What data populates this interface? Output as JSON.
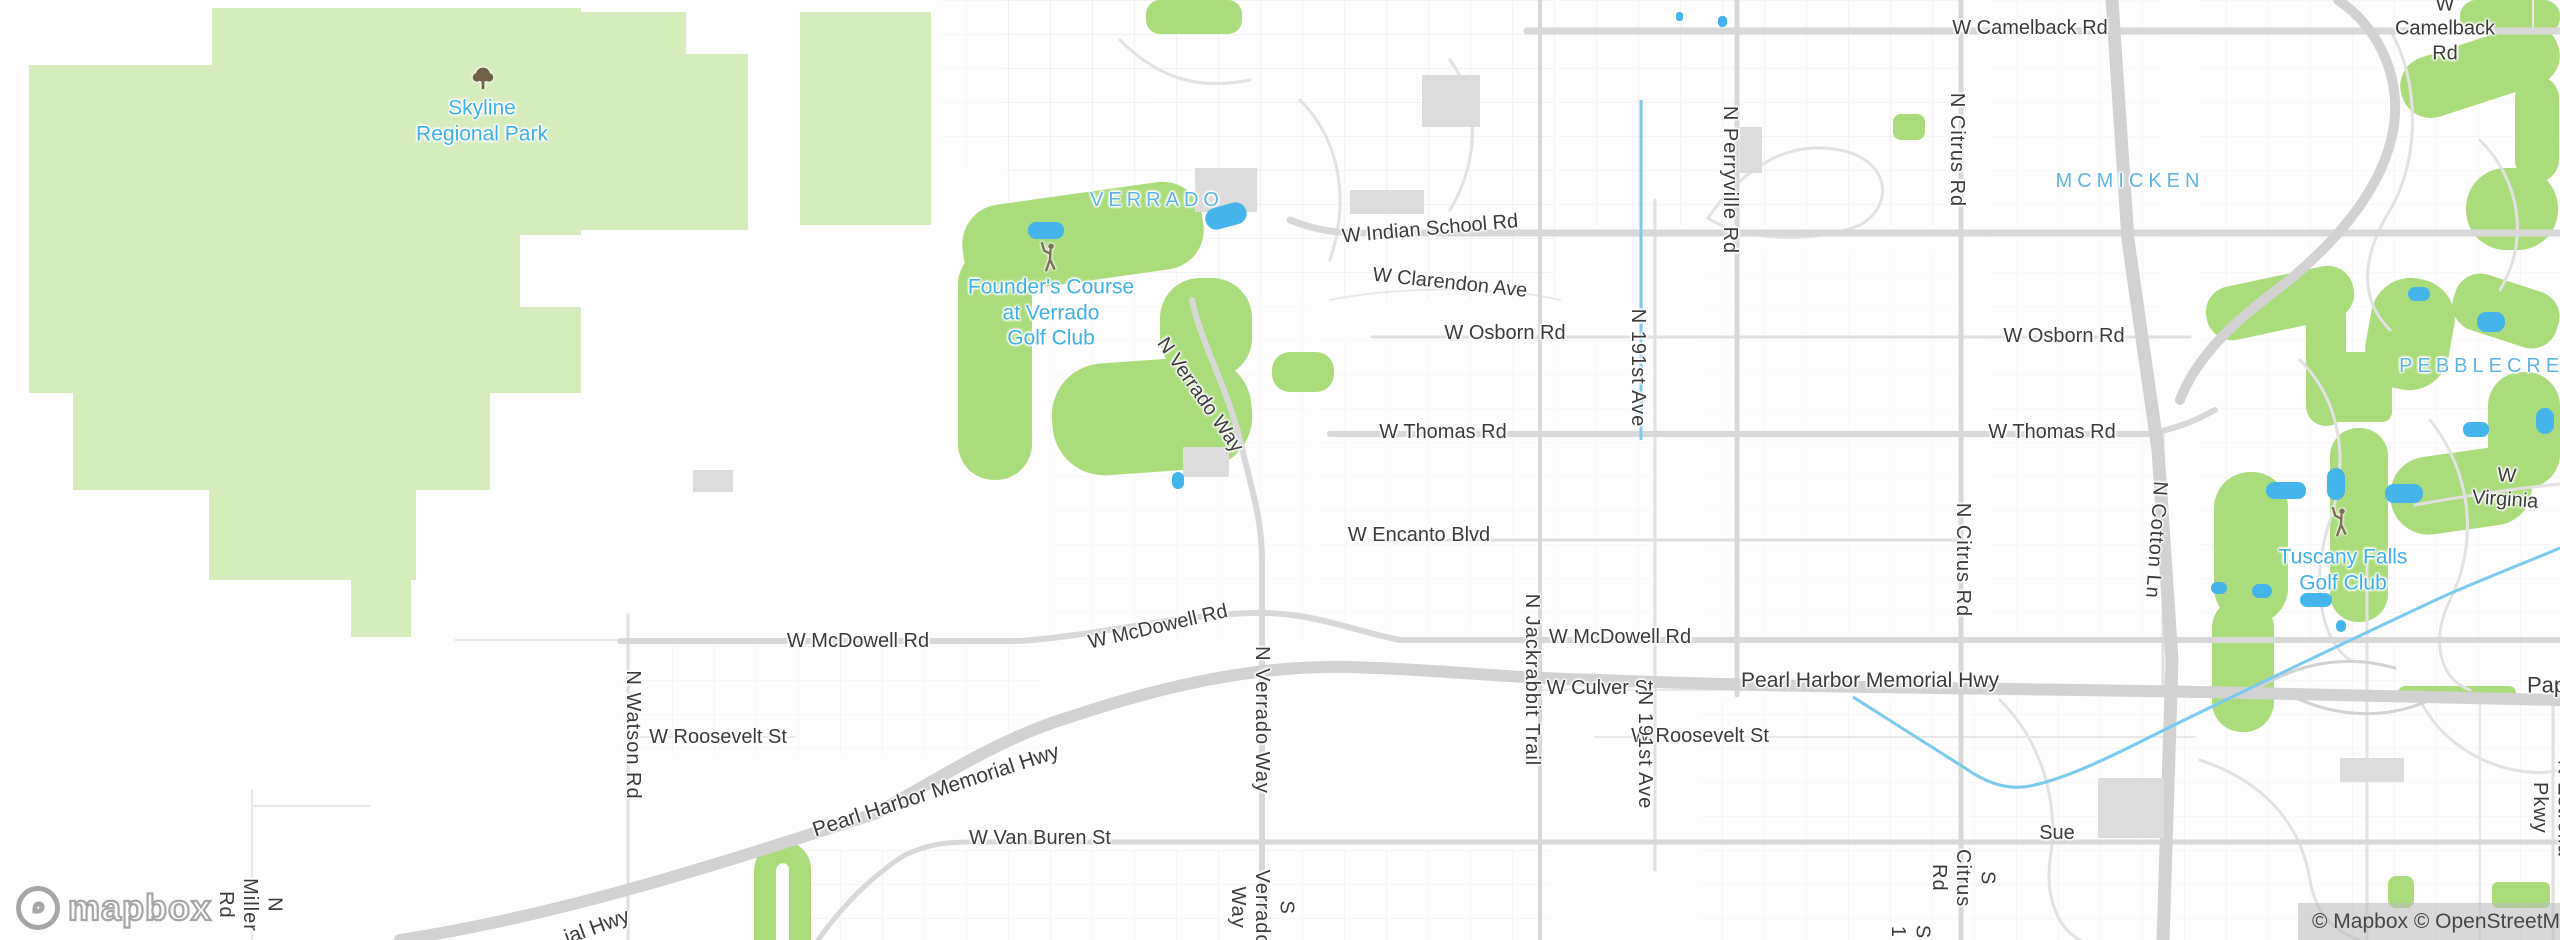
{
  "map": {
    "colors": {
      "park_green": "#d6ecbd",
      "golf_green": "#abdc7c",
      "water_blue": "#45b4ea",
      "canal_blue": "#7ac9ef",
      "road_gray": "#d8d8d8",
      "highway_gray": "#d2d2d2",
      "place_label_blue": "#5fb4e2",
      "poi_label_blue": "#3fb0e6",
      "road_label_dark": "#3b3b3b"
    },
    "labels": [
      {
        "name": "park-label-skyline",
        "text": "Skyline\nRegional Park",
        "x": 482,
        "y": 121,
        "cls": "poi",
        "size": 21
      },
      {
        "name": "place-label-verrado",
        "text": "VERRADO",
        "x": 1157,
        "y": 200,
        "cls": "place",
        "ls": 5
      },
      {
        "name": "poi-label-founders-course",
        "text": "Founder's Course\nat Verrado\nGolf Club",
        "x": 1051,
        "y": 313,
        "cls": "poi",
        "size": 21
      },
      {
        "name": "place-label-mcmicken",
        "text": "MCMICKEN",
        "x": 2130,
        "y": 181,
        "cls": "place",
        "ls": 5
      },
      {
        "name": "place-label-pebblecreek",
        "text": "PEBBLECREEK",
        "x": 2500,
        "y": 366,
        "cls": "place",
        "ls": 5
      },
      {
        "name": "poi-label-tuscany-falls",
        "text": "Tuscany Falls\nGolf Club",
        "x": 2343,
        "y": 570,
        "cls": "poi",
        "size": 21
      },
      {
        "name": "road-label-camelback-1",
        "text": "W Camelback Rd",
        "x": 2030,
        "y": 28,
        "cls": "road"
      },
      {
        "name": "road-label-camelback-2",
        "text": "W Camelback Rd",
        "x": 2445,
        "y": 29,
        "cls": "road"
      },
      {
        "name": "road-label-indian-school",
        "text": "W Indian School Rd",
        "x": 1430,
        "y": 229,
        "cls": "road",
        "rot": -5
      },
      {
        "name": "road-label-clarendon",
        "text": "W Clarendon Ave",
        "x": 1450,
        "y": 283,
        "cls": "road",
        "rot": 6
      },
      {
        "name": "road-label-osborn-1",
        "text": "W Osborn Rd",
        "x": 1505,
        "y": 333,
        "cls": "road"
      },
      {
        "name": "road-label-osborn-2",
        "text": "W Osborn Rd",
        "x": 2064,
        "y": 336,
        "cls": "road"
      },
      {
        "name": "road-label-thomas-1",
        "text": "W Thomas Rd",
        "x": 1443,
        "y": 432,
        "cls": "road"
      },
      {
        "name": "road-label-thomas-2",
        "text": "W Thomas Rd",
        "x": 2052,
        "y": 432,
        "cls": "road"
      },
      {
        "name": "road-label-encanto",
        "text": "W Encanto Blvd",
        "x": 1419,
        "y": 535,
        "cls": "road"
      },
      {
        "name": "road-label-mcdowell-1",
        "text": "W McDowell Rd",
        "x": 858,
        "y": 641,
        "cls": "road"
      },
      {
        "name": "road-label-mcdowell-2",
        "text": "W McDowell Rd",
        "x": 1158,
        "y": 627,
        "cls": "road",
        "rot": -13
      },
      {
        "name": "road-label-mcdowell-3",
        "text": "W McDowell Rd",
        "x": 1620,
        "y": 637,
        "cls": "road"
      },
      {
        "name": "road-label-culver",
        "text": "W Culver St",
        "x": 1600,
        "y": 688,
        "cls": "road"
      },
      {
        "name": "road-label-pearl-harbor-1",
        "text": "Pearl Harbor Memorial Hwy",
        "x": 1870,
        "y": 681,
        "cls": "road",
        "size": 21
      },
      {
        "name": "road-label-pearl-harbor-2",
        "text": "Pearl Harbor Memorial Hwy",
        "x": 936,
        "y": 791,
        "cls": "road",
        "size": 21,
        "rot": -18
      },
      {
        "name": "road-label-pearl-harbor-partial",
        "text": "ial Hwy",
        "x": 597,
        "y": 927,
        "cls": "road",
        "size": 21,
        "rot": -20
      },
      {
        "name": "road-label-roosevelt-1",
        "text": "W Roosevelt St",
        "x": 718,
        "y": 737,
        "cls": "road"
      },
      {
        "name": "road-label-roosevelt-2",
        "text": "W Roosevelt St",
        "x": 1700,
        "y": 736,
        "cls": "road"
      },
      {
        "name": "road-label-van-buren",
        "text": "W Van Buren St",
        "x": 1040,
        "y": 838,
        "cls": "road"
      },
      {
        "name": "road-label-sue",
        "text": "Sue",
        "x": 2057,
        "y": 833,
        "cls": "road"
      },
      {
        "name": "road-label-virginia",
        "text": "W Virginia",
        "x": 2506,
        "y": 488,
        "cls": "road",
        "rot": 4
      },
      {
        "name": "road-label-papago-partial",
        "text": "Pap",
        "x": 2527,
        "y": 686,
        "cls": "road",
        "size": 22,
        "anchor": "left"
      },
      {
        "name": "road-label-watson",
        "text": "N Watson Rd",
        "x": 633,
        "y": 735,
        "cls": "road",
        "v": true
      },
      {
        "name": "road-label-miller",
        "text": "N Miller Rd",
        "x": 250,
        "y": 905,
        "cls": "road",
        "v": true
      },
      {
        "name": "road-label-verrado-way-n1",
        "text": "N Verrado Way",
        "x": 1200,
        "y": 395,
        "cls": "road",
        "rot": 55
      },
      {
        "name": "road-label-verrado-way-n2",
        "text": "N Verrado Way",
        "x": 1262,
        "y": 720,
        "cls": "road",
        "v": true
      },
      {
        "name": "road-label-verrado-way-s",
        "text": "S Verrado Way",
        "x": 1262,
        "y": 908,
        "cls": "road",
        "v": true
      },
      {
        "name": "road-label-jackrabbit",
        "text": "N Jackrabbit Trail",
        "x": 1532,
        "y": 680,
        "cls": "road",
        "v": true
      },
      {
        "name": "road-label-191st-1",
        "text": "N 191st Ave",
        "x": 1638,
        "y": 368,
        "cls": "road",
        "v": true
      },
      {
        "name": "road-label-191st-2",
        "text": "N 191st Ave",
        "x": 1645,
        "y": 750,
        "cls": "road",
        "v": true
      },
      {
        "name": "road-label-perryville",
        "text": "N Perryville Rd",
        "x": 1730,
        "y": 180,
        "cls": "road",
        "v": true
      },
      {
        "name": "road-label-citrus-n1",
        "text": "N Citrus Rd",
        "x": 1957,
        "y": 150,
        "cls": "road",
        "v": true
      },
      {
        "name": "road-label-citrus-n2",
        "text": "N Citrus Rd",
        "x": 1963,
        "y": 560,
        "cls": "road",
        "v": true
      },
      {
        "name": "road-label-citrus-s",
        "text": "S Citrus Rd",
        "x": 1963,
        "y": 878,
        "cls": "road",
        "v": true
      },
      {
        "name": "road-label-s1-partial",
        "text": "S 1",
        "x": 1910,
        "y": 932,
        "cls": "road",
        "v": true
      },
      {
        "name": "road-label-cotton",
        "text": "N Cotton Ln",
        "x": 2156,
        "y": 540,
        "cls": "road",
        "v": true,
        "rot": 4
      },
      {
        "name": "road-label-estrella",
        "text": "N Estrella Pkwy",
        "x": 2552,
        "y": 808,
        "cls": "road",
        "v": true
      }
    ],
    "icons": [
      {
        "name": "park-tree-icon",
        "symbol": "sym-tree",
        "x": 483,
        "y": 82,
        "w": 26,
        "h": 30
      },
      {
        "name": "golfer-icon",
        "symbol": "sym-golfer",
        "x": 1050,
        "y": 260,
        "w": 26,
        "h": 32
      },
      {
        "name": "golfer-icon",
        "symbol": "sym-golfer",
        "x": 2341,
        "y": 525,
        "w": 26,
        "h": 32
      }
    ]
  },
  "branding": {
    "logo_text": "mapbox"
  },
  "attribution": {
    "text": "© Mapbox © OpenStreetMap"
  }
}
